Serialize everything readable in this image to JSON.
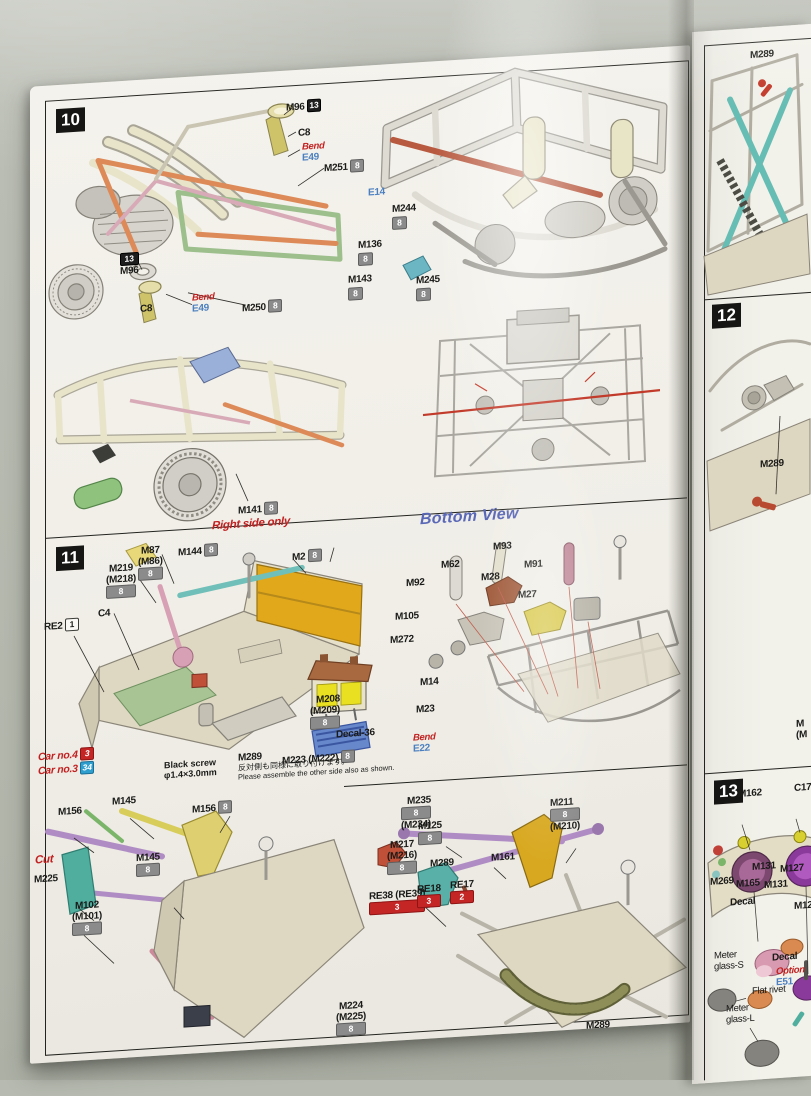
{
  "document_title": "Model kit assembly instructions - steps 10-13",
  "colors": {
    "badge_gray": "#8b8b8b",
    "badge_red": "#c42626",
    "badge_blue": "#2f9fd0",
    "badge_black": "#1d1d1d",
    "accent_red": "#c22020",
    "accent_blue": "#4a7fc0",
    "bottom_view_blue": "#5a68b8",
    "paper": "#f2f0ea"
  },
  "left_page": {
    "step10": {
      "num": "10",
      "labels": [
        {
          "t": "M96",
          "b": "13"
        },
        {
          "t": "C8"
        },
        {
          "t": "Bend",
          "e": "E49"
        },
        {
          "t": "M251",
          "b": "8"
        },
        {
          "t": "E14"
        },
        {
          "t": "M244",
          "b": "8"
        },
        {
          "t": "M136",
          "b": "8"
        },
        {
          "t": "M143",
          "b": "8"
        },
        {
          "t": "M245",
          "b": "8"
        },
        {
          "t": "M250",
          "b": "8"
        },
        {
          "t": "M96",
          "b": "13"
        },
        {
          "t": "C8"
        },
        {
          "t": "Bend",
          "e": "E49"
        },
        {
          "t": "M141",
          "b": "8"
        },
        {
          "t": "Right side only"
        },
        {
          "t": "Bottom View"
        }
      ]
    },
    "step11": {
      "num": "11",
      "labels": [
        {
          "t": "M87",
          "s": "(M86)",
          "b": "8"
        },
        {
          "t": "M144",
          "b": "8"
        },
        {
          "t": "M2",
          "b": "8"
        },
        {
          "t": "M219",
          "s": "(M218)",
          "b": "8"
        },
        {
          "t": "C4"
        },
        {
          "t": "RE2",
          "b": "1"
        },
        {
          "t": "M93"
        },
        {
          "t": "M62"
        },
        {
          "t": "M91"
        },
        {
          "t": "M92"
        },
        {
          "t": "M28"
        },
        {
          "t": "M27"
        },
        {
          "t": "M105"
        },
        {
          "t": "M272"
        },
        {
          "t": "M14"
        },
        {
          "t": "M23"
        },
        {
          "t": "M208",
          "s": "(M209)",
          "b": "8"
        },
        {
          "t": "Decal-36"
        },
        {
          "t": "Bend",
          "e": "E22"
        },
        {
          "t": "M289"
        },
        {
          "t": "M223 (M222)",
          "b": "8"
        },
        {
          "t": "Black screw",
          "s": "φ1.4×3.0mm"
        },
        {
          "jp": "反対側も同様に取り付けます。",
          "en": "Please assemble the other side also as shown."
        },
        {
          "t": "Car no.4",
          "b": "3"
        },
        {
          "t": "Car no.3",
          "b": "34"
        }
      ]
    },
    "bottom_left": {
      "labels": [
        {
          "t": "M156"
        },
        {
          "t": "M145"
        },
        {
          "t": "M156",
          "b": "8"
        },
        {
          "t": "M145",
          "b": "8"
        },
        {
          "t": "Cut"
        },
        {
          "t": "M225"
        },
        {
          "t": "M102",
          "s": "(M101)",
          "b": "8"
        },
        {
          "t": "M224",
          "s": "(M225)",
          "b": "8"
        }
      ]
    },
    "bottom_right": {
      "labels": [
        {
          "t": "M235",
          "s": "(M234)",
          "b": "8"
        },
        {
          "t": "M211",
          "s": "(M210)",
          "b": "8"
        },
        {
          "t": "M125",
          "b": "8"
        },
        {
          "t": "M217",
          "s": "(M216)",
          "b": "8"
        },
        {
          "t": "M289"
        },
        {
          "t": "M161"
        },
        {
          "t": "RE38 (RE39)",
          "b": "3"
        },
        {
          "t": "RE18",
          "b": "3"
        },
        {
          "t": "RE17",
          "b": "2"
        },
        {
          "t": "M289"
        }
      ]
    }
  },
  "right_page": {
    "top": {
      "labels": [
        {
          "t": "M289"
        }
      ]
    },
    "step12": {
      "num": "12",
      "labels": [
        {
          "t": "M289"
        },
        {
          "t": "M",
          "s": "(M"
        }
      ]
    },
    "step13": {
      "num": "13",
      "labels": [
        {
          "t": "M162"
        },
        {
          "t": "C17"
        },
        {
          "t": "M131"
        },
        {
          "t": "M127"
        },
        {
          "t": "M269"
        },
        {
          "t": "M165"
        },
        {
          "t": "M131"
        },
        {
          "t": "Decal"
        },
        {
          "t": "M12"
        },
        {
          "t": "Meter",
          "s": "glass-S"
        },
        {
          "t": "Decal"
        },
        {
          "t": "Option",
          "e": "E51"
        },
        {
          "t": "Flat rivet"
        },
        {
          "t": "Meter",
          "s": "glass-L"
        }
      ]
    }
  }
}
